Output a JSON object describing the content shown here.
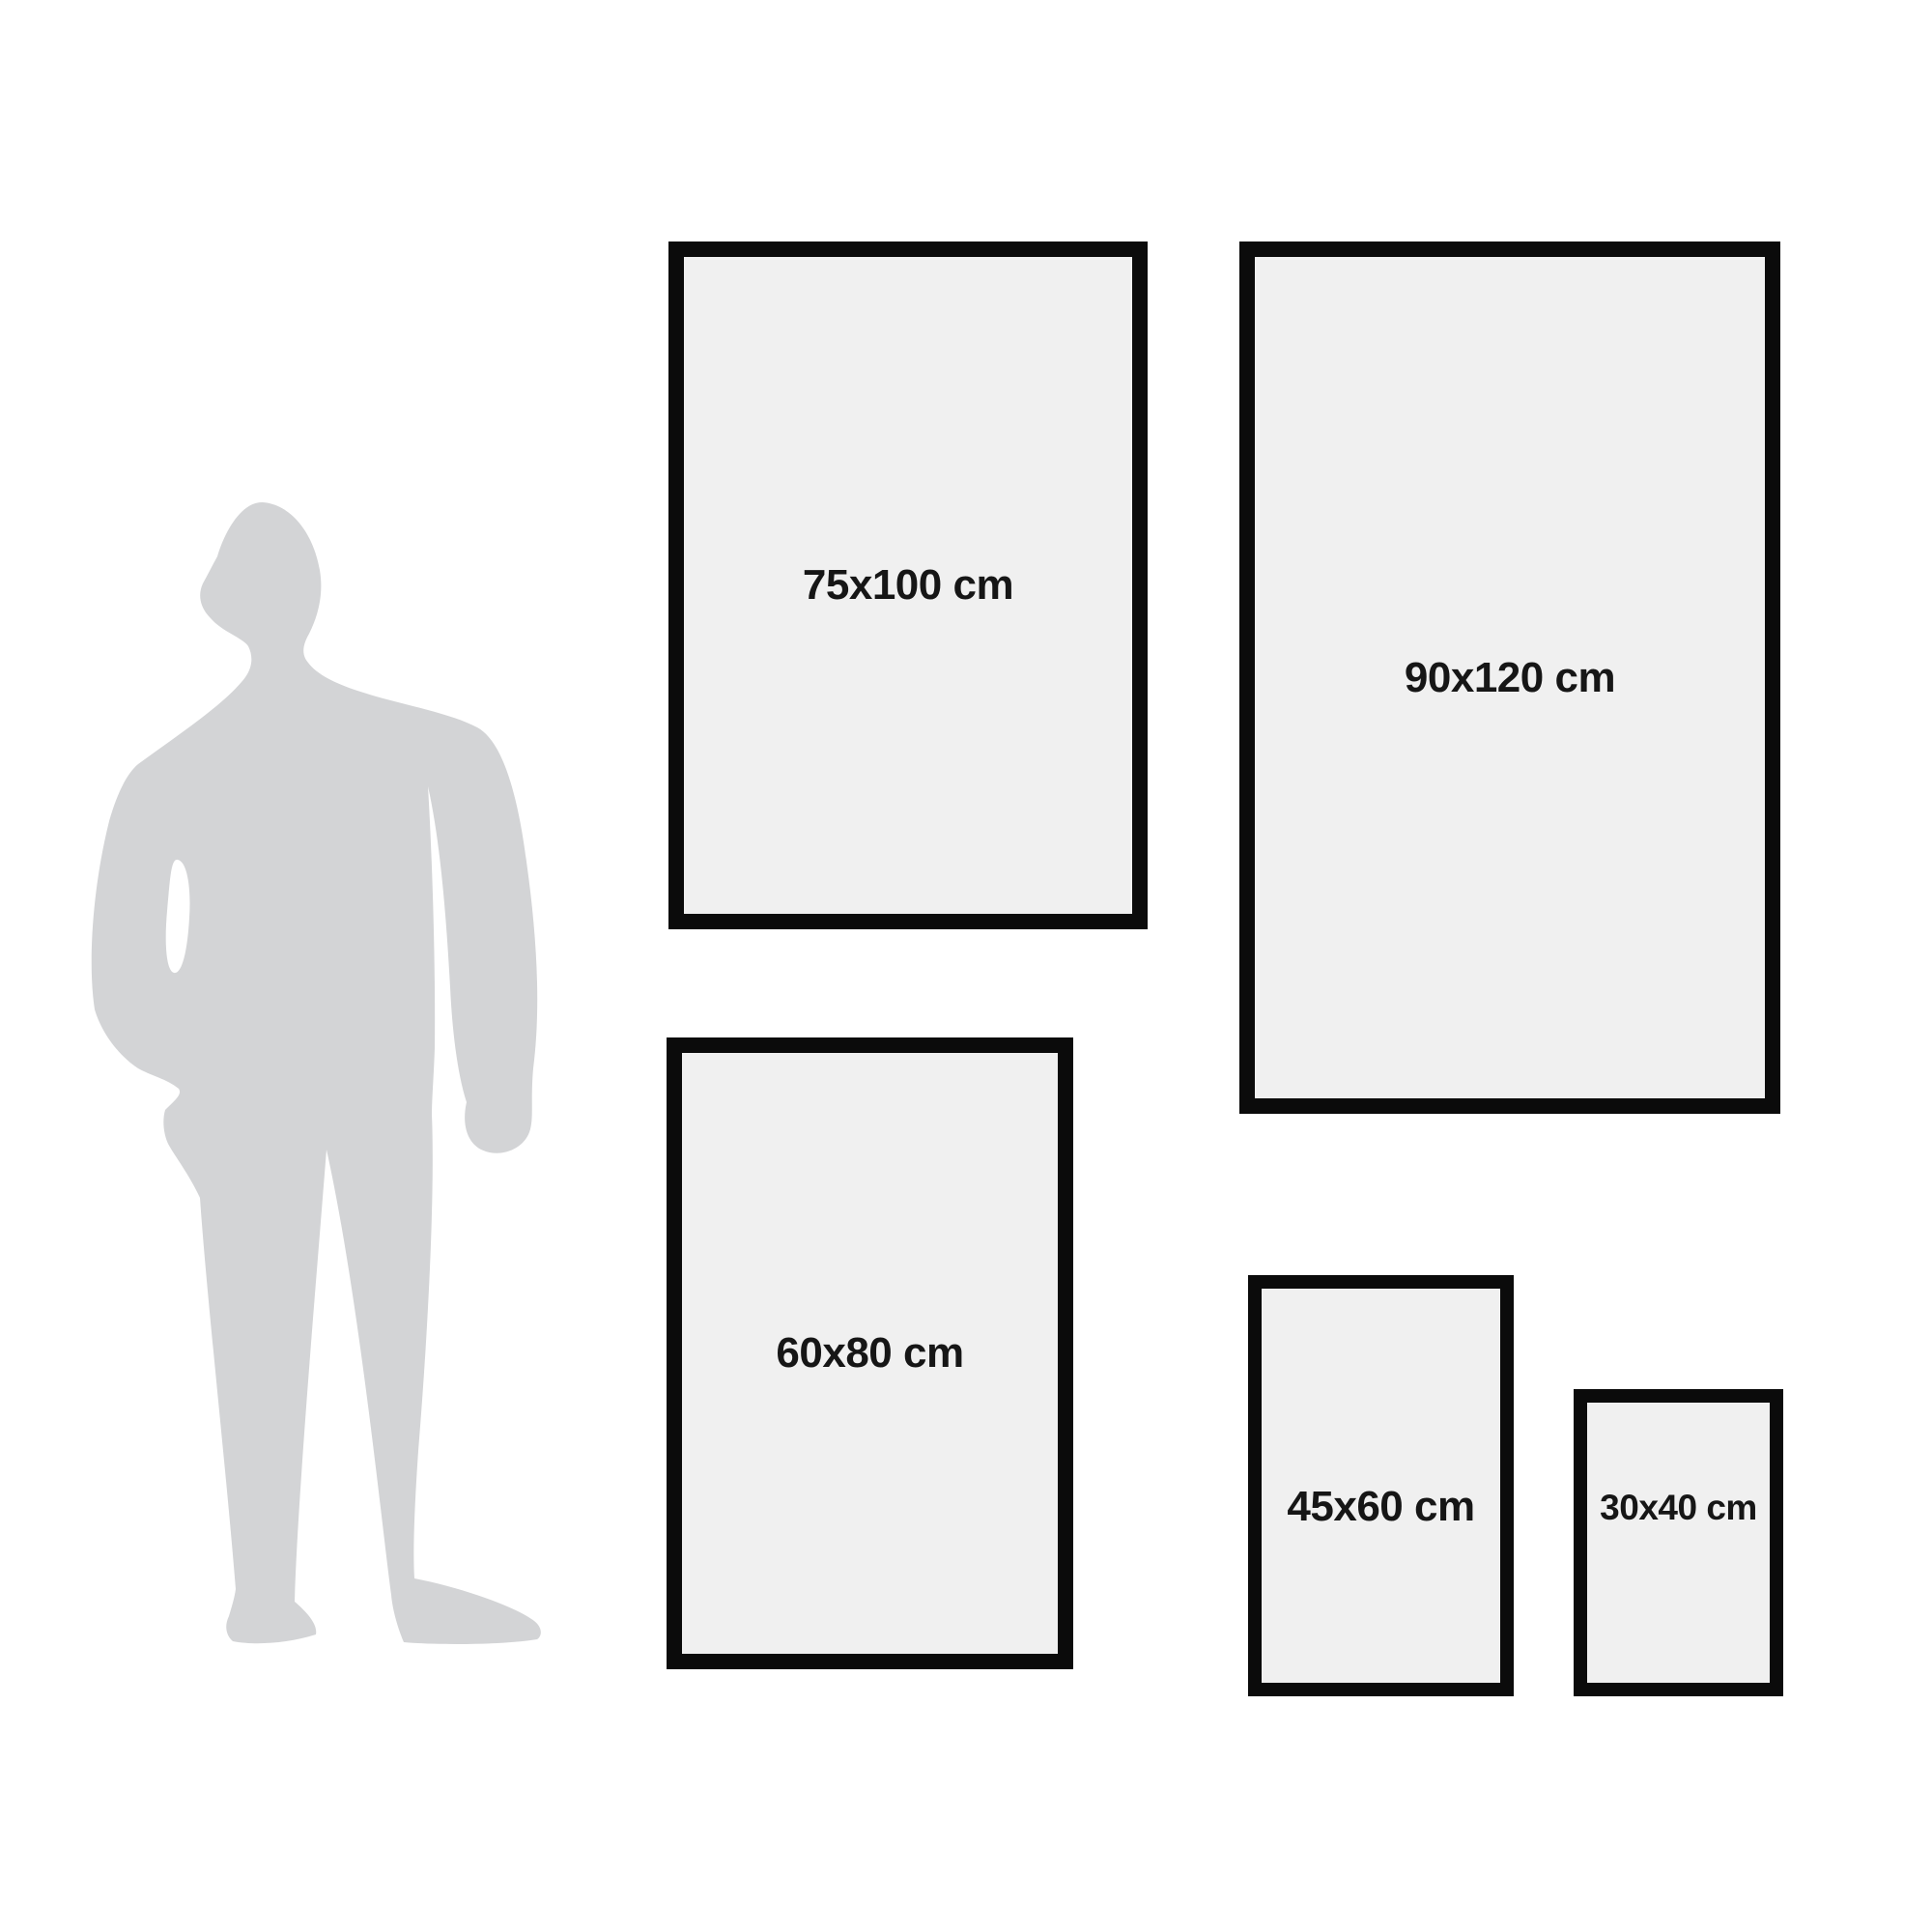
{
  "title": "poster-frame-size-comparison",
  "colors": {
    "background": "#ffffff",
    "frame_border": "#0b0b0b",
    "frame_fill": "#f0f0f0",
    "label_text": "#161616",
    "silhouette": "#d3d4d6"
  },
  "silhouette": {
    "name": "standing-man-silhouette"
  },
  "frames": [
    {
      "label": "75x100 cm"
    },
    {
      "label": "90x120 cm"
    },
    {
      "label": "60x80 cm"
    },
    {
      "label": "45x60 cm"
    },
    {
      "label": "30x40 cm"
    }
  ]
}
